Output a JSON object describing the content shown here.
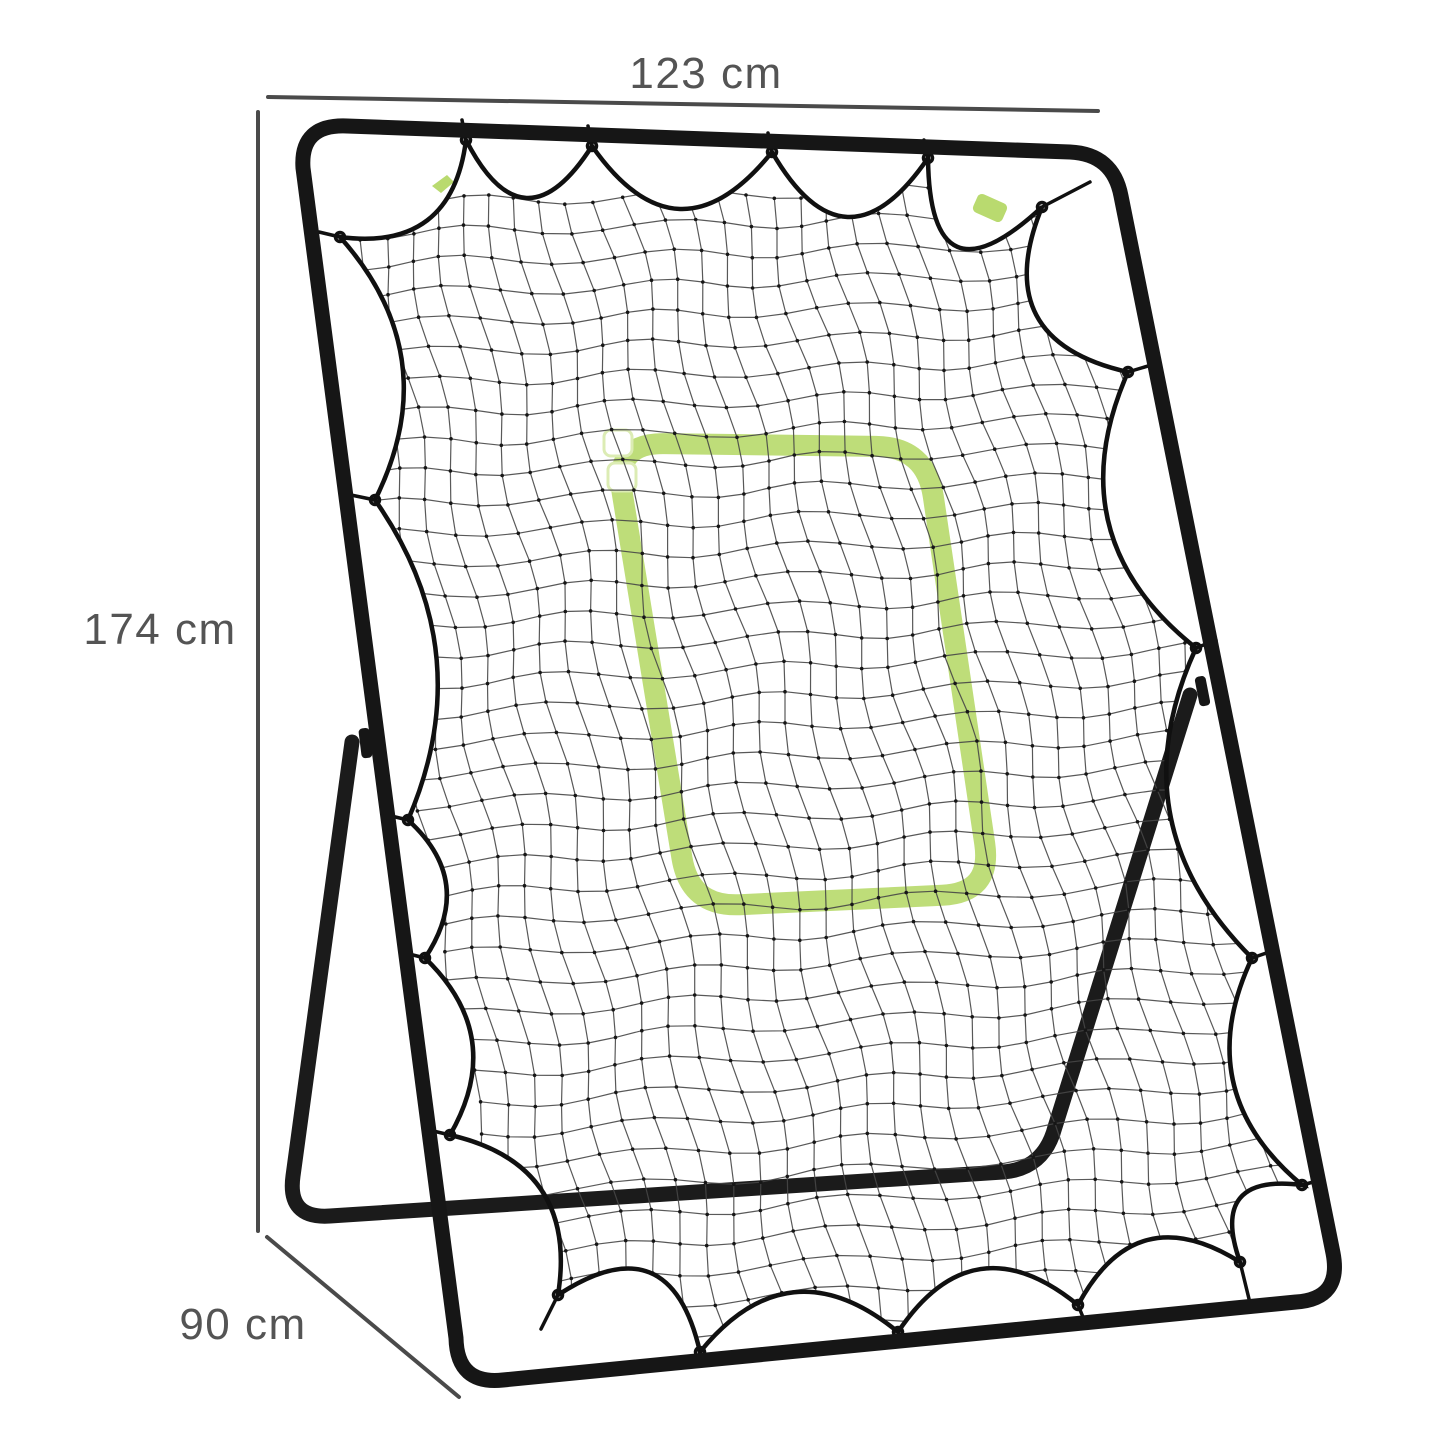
{
  "dimensions": {
    "width": {
      "label": "123 cm"
    },
    "height": {
      "label": "174 cm"
    },
    "depth": {
      "label": "90 cm"
    }
  },
  "colors": {
    "frame": "#161616",
    "rear_frame": "#1b1b1b",
    "net_line": "#474747",
    "net_knot": "#161616",
    "net_rope": "#101010",
    "target_green": "#b9da6f",
    "target_patch": "#ffffff",
    "dimension_line": "#4a4a4a",
    "dimension_text": "#545454",
    "background": "#ffffff"
  }
}
